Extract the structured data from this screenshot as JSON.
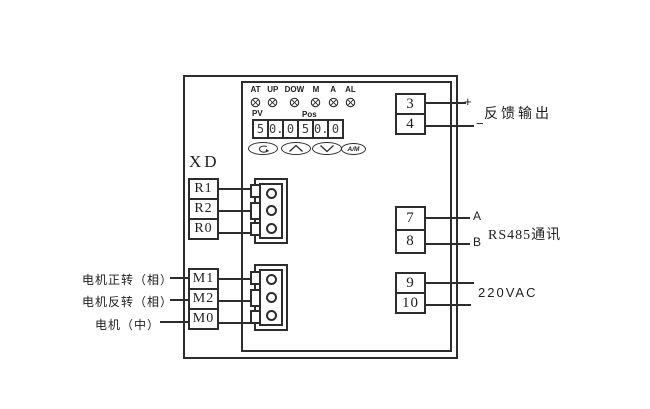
{
  "device": {
    "indicators": [
      "AT",
      "UP",
      "DOW",
      "M",
      "A",
      "AL"
    ],
    "display": {
      "pv_label": "PV",
      "pos_label": "Pos",
      "digits": [
        "5",
        "0.",
        "0",
        "5",
        "0.",
        "0"
      ]
    },
    "buttons": {
      "set_icon": "loop-arrow-icon",
      "up_icon": "up-arrow-icon",
      "down_icon": "down-arrow-icon",
      "am_label": "A/M"
    }
  },
  "connector_label": "XD",
  "r_terminals": [
    "R1",
    "R2",
    "R0"
  ],
  "m_terminals": [
    "M1",
    "M2",
    "M0"
  ],
  "motor_labels": [
    "电机正转（相）",
    "电机反转（相）",
    "电机（中）"
  ],
  "feedback": {
    "terminals": [
      "3",
      "4"
    ],
    "polarity": [
      "+",
      "−"
    ],
    "caption": "反馈输出"
  },
  "rs485": {
    "terminals": [
      "7",
      "8"
    ],
    "wires": [
      "A",
      "B"
    ],
    "caption": "RS485通讯"
  },
  "power": {
    "terminals": [
      "9",
      "10"
    ],
    "caption": "220VAC"
  }
}
